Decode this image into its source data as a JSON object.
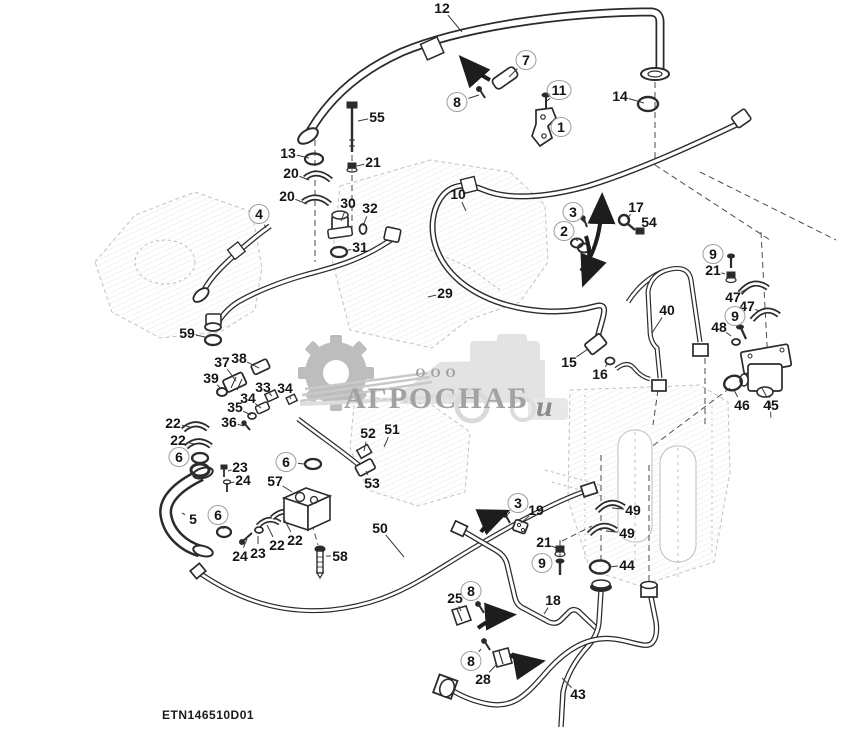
{
  "footer": {
    "code": "ETN146510D01"
  },
  "watermark": {
    "ooo": "ООО",
    "name": "АГРОСНАБ",
    "suffix": "u"
  },
  "colors": {
    "line": "#2b2b2b",
    "faint": "#c2c2c2",
    "watermark_gray": "#a6a6a6",
    "arrow": "#1d1d1d"
  },
  "callouts": [
    {
      "n": "12",
      "x": 442,
      "y": 8,
      "c": 0,
      "lx": 462,
      "ly": 32
    },
    {
      "n": "7",
      "x": 526,
      "y": 60,
      "c": 1,
      "lx": 509,
      "ly": 77
    },
    {
      "n": "8",
      "x": 457,
      "y": 102,
      "c": 1,
      "lx": 479,
      "ly": 95
    },
    {
      "n": "11",
      "x": 559,
      "y": 90,
      "c": 1,
      "lx": 547,
      "ly": 101
    },
    {
      "n": "1",
      "x": 561,
      "y": 127,
      "c": 1,
      "lx": 547,
      "ly": 128
    },
    {
      "n": "14",
      "x": 620,
      "y": 96,
      "c": 0,
      "lx": 644,
      "ly": 103
    },
    {
      "n": "55",
      "x": 377,
      "y": 117,
      "c": 0,
      "lx": 358,
      "ly": 121
    },
    {
      "n": "13",
      "x": 288,
      "y": 153,
      "c": 0,
      "lx": 309,
      "ly": 158
    },
    {
      "n": "21",
      "x": 373,
      "y": 162,
      "c": 0,
      "lx": 357,
      "ly": 166
    },
    {
      "n": "20",
      "x": 291,
      "y": 173,
      "c": 0,
      "lx": 309,
      "ly": 180
    },
    {
      "n": "20",
      "x": 287,
      "y": 196,
      "c": 0,
      "lx": 307,
      "ly": 204
    },
    {
      "n": "4",
      "x": 259,
      "y": 214,
      "c": 1,
      "lx": 266,
      "ly": 228
    },
    {
      "n": "30",
      "x": 348,
      "y": 203,
      "c": 0,
      "lx": 341,
      "ly": 221
    },
    {
      "n": "32",
      "x": 370,
      "y": 208,
      "c": 0,
      "lx": 363,
      "ly": 226
    },
    {
      "n": "31",
      "x": 360,
      "y": 247,
      "c": 0,
      "lx": 345,
      "ly": 251
    },
    {
      "n": "10",
      "x": 458,
      "y": 194,
      "c": 0,
      "lx": 466,
      "ly": 211
    },
    {
      "n": "3",
      "x": 573,
      "y": 212,
      "c": 1,
      "lx": 584,
      "ly": 222
    },
    {
      "n": "2",
      "x": 564,
      "y": 231,
      "c": 1,
      "lx": 578,
      "ly": 241
    },
    {
      "n": "17",
      "x": 636,
      "y": 207,
      "c": 0,
      "lx": 627,
      "ly": 219
    },
    {
      "n": "54",
      "x": 649,
      "y": 222,
      "c": 0,
      "lx": 641,
      "ly": 229
    },
    {
      "n": "9",
      "x": 713,
      "y": 254,
      "c": 1,
      "lx": 726,
      "ly": 259
    },
    {
      "n": "21",
      "x": 713,
      "y": 270,
      "c": 0,
      "lx": 725,
      "ly": 274
    },
    {
      "n": "47",
      "x": 733,
      "y": 297,
      "c": 0,
      "lx": 748,
      "ly": 288
    },
    {
      "n": "47",
      "x": 747,
      "y": 306,
      "c": 0,
      "lx": 759,
      "ly": 311
    },
    {
      "n": "9",
      "x": 735,
      "y": 316,
      "c": 1,
      "lx": 742,
      "ly": 326
    },
    {
      "n": "48",
      "x": 719,
      "y": 327,
      "c": 0,
      "lx": 731,
      "ly": 336
    },
    {
      "n": "29",
      "x": 445,
      "y": 293,
      "c": 0,
      "lx": 428,
      "ly": 297
    },
    {
      "n": "40",
      "x": 667,
      "y": 310,
      "c": 0,
      "lx": 652,
      "ly": 333
    },
    {
      "n": "59",
      "x": 187,
      "y": 333,
      "c": 0,
      "lx": 205,
      "ly": 337
    },
    {
      "n": "38",
      "x": 239,
      "y": 358,
      "c": 0,
      "lx": 259,
      "ly": 368
    },
    {
      "n": "37",
      "x": 222,
      "y": 362,
      "c": 0,
      "lx": 236,
      "ly": 381
    },
    {
      "n": "39",
      "x": 211,
      "y": 378,
      "c": 0,
      "lx": 221,
      "ly": 389
    },
    {
      "n": "33",
      "x": 263,
      "y": 387,
      "c": 0,
      "lx": 272,
      "ly": 396
    },
    {
      "n": "34",
      "x": 285,
      "y": 388,
      "c": 0,
      "lx": 291,
      "ly": 399
    },
    {
      "n": "34",
      "x": 248,
      "y": 398,
      "c": 0,
      "lx": 261,
      "ly": 408
    },
    {
      "n": "35",
      "x": 235,
      "y": 407,
      "c": 0,
      "lx": 251,
      "ly": 415
    },
    {
      "n": "36",
      "x": 229,
      "y": 422,
      "c": 0,
      "lx": 244,
      "ly": 426
    },
    {
      "n": "15",
      "x": 569,
      "y": 362,
      "c": 0,
      "lx": 588,
      "ly": 349
    },
    {
      "n": "16",
      "x": 600,
      "y": 374,
      "c": 0,
      "lx": 608,
      "ly": 363
    },
    {
      "n": "46",
      "x": 742,
      "y": 405,
      "c": 0,
      "lx": 734,
      "ly": 390
    },
    {
      "n": "45",
      "x": 771,
      "y": 405,
      "c": 0,
      "lx": 762,
      "ly": 388
    },
    {
      "n": "22",
      "x": 173,
      "y": 423,
      "c": 0,
      "lx": 190,
      "ly": 427
    },
    {
      "n": "22",
      "x": 178,
      "y": 440,
      "c": 0,
      "lx": 194,
      "ly": 444
    },
    {
      "n": "6",
      "x": 179,
      "y": 457,
      "c": 1,
      "lx": 194,
      "ly": 458
    },
    {
      "n": "23",
      "x": 240,
      "y": 467,
      "c": 0,
      "lx": 228,
      "ly": 471
    },
    {
      "n": "24",
      "x": 243,
      "y": 480,
      "c": 0,
      "lx": 230,
      "ly": 483
    },
    {
      "n": "6",
      "x": 286,
      "y": 462,
      "c": 1,
      "lx": 304,
      "ly": 464
    },
    {
      "n": "57",
      "x": 275,
      "y": 481,
      "c": 0,
      "lx": 292,
      "ly": 492
    },
    {
      "n": "52",
      "x": 368,
      "y": 433,
      "c": 0,
      "lx": 364,
      "ly": 451
    },
    {
      "n": "51",
      "x": 392,
      "y": 429,
      "c": 0,
      "lx": 384,
      "ly": 447
    },
    {
      "n": "53",
      "x": 372,
      "y": 483,
      "c": 0,
      "lx": 366,
      "ly": 471
    },
    {
      "n": "5",
      "x": 193,
      "y": 519,
      "c": 0,
      "lx": 182,
      "ly": 513
    },
    {
      "n": "6",
      "x": 218,
      "y": 515,
      "c": 1,
      "lx": 224,
      "ly": 529
    },
    {
      "n": "24",
      "x": 240,
      "y": 556,
      "c": 0,
      "lx": 247,
      "ly": 539
    },
    {
      "n": "23",
      "x": 258,
      "y": 553,
      "c": 0,
      "lx": 258,
      "ly": 536
    },
    {
      "n": "22",
      "x": 277,
      "y": 545,
      "c": 0,
      "lx": 267,
      "ly": 525
    },
    {
      "n": "22",
      "x": 295,
      "y": 540,
      "c": 0,
      "lx": 283,
      "ly": 517
    },
    {
      "n": "58",
      "x": 340,
      "y": 556,
      "c": 0,
      "lx": 326,
      "ly": 556
    },
    {
      "n": "50",
      "x": 380,
      "y": 528,
      "c": 0,
      "lx": 404,
      "ly": 557
    },
    {
      "n": "3",
      "x": 518,
      "y": 503,
      "c": 1,
      "lx": 508,
      "ly": 514
    },
    {
      "n": "19",
      "x": 536,
      "y": 510,
      "c": 0,
      "lx": 521,
      "ly": 523
    },
    {
      "n": "21",
      "x": 544,
      "y": 542,
      "c": 0,
      "lx": 556,
      "ly": 548
    },
    {
      "n": "9",
      "x": 542,
      "y": 563,
      "c": 1,
      "lx": 555,
      "ly": 566
    },
    {
      "n": "44",
      "x": 627,
      "y": 565,
      "c": 0,
      "lx": 609,
      "ly": 567
    },
    {
      "n": "49",
      "x": 633,
      "y": 510,
      "c": 0,
      "lx": 612,
      "ly": 508
    },
    {
      "n": "49",
      "x": 627,
      "y": 533,
      "c": 0,
      "lx": 606,
      "ly": 531
    },
    {
      "n": "25",
      "x": 455,
      "y": 598,
      "c": 0,
      "lx": 461,
      "ly": 611
    },
    {
      "n": "8",
      "x": 471,
      "y": 591,
      "c": 1,
      "lx": 479,
      "ly": 603
    },
    {
      "n": "18",
      "x": 553,
      "y": 600,
      "c": 0,
      "lx": 544,
      "ly": 614
    },
    {
      "n": "8",
      "x": 471,
      "y": 661,
      "c": 1,
      "lx": 481,
      "ly": 649
    },
    {
      "n": "28",
      "x": 483,
      "y": 679,
      "c": 0,
      "lx": 496,
      "ly": 665
    },
    {
      "n": "43",
      "x": 578,
      "y": 694,
      "c": 0,
      "lx": 562,
      "ly": 678
    }
  ]
}
